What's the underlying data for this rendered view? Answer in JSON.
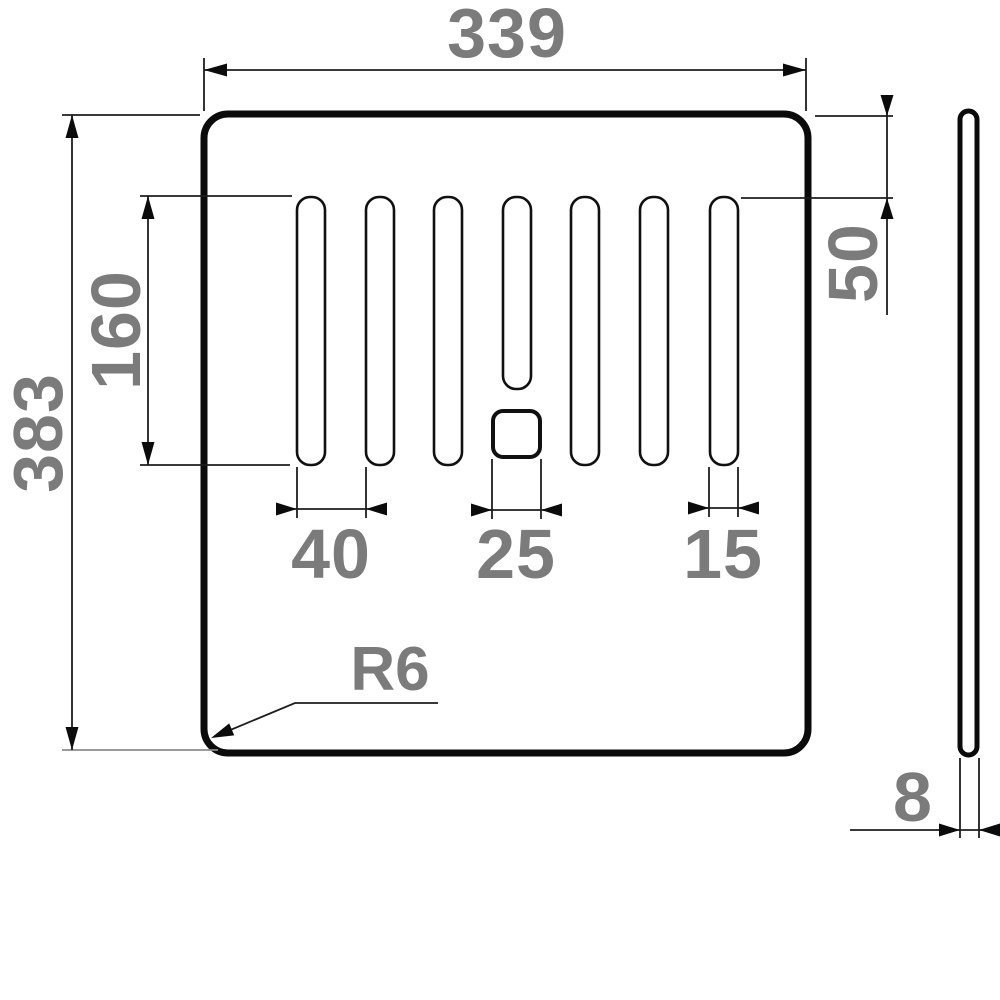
{
  "drawing": {
    "type": "technical-dimension-drawing",
    "views": [
      "front-view-plate",
      "side-view-thickness"
    ],
    "slot_count": 7,
    "labels": {
      "overall_width": "339",
      "overall_height": "383",
      "slot_length": "160",
      "slot_top_offset": "50",
      "slot_pitch": "40",
      "square_hole_width": "25",
      "slot_width": "15",
      "corner_radius": "R6",
      "thickness": "8"
    },
    "values": {
      "overall_width_mm": 339,
      "overall_height_mm": 383,
      "slot_length_mm": 160,
      "slot_top_offset_mm": 50,
      "slot_pitch_mm": 40,
      "square_hole_width_mm": 25,
      "slot_width_mm": 15,
      "corner_radius_mm": 6,
      "thickness_mm": 8
    },
    "colors": {
      "background": "#ffffff",
      "outline": "#0b0b0b",
      "dimension_lines": "#1d1d1d",
      "labels": "#7b7b7b"
    }
  }
}
